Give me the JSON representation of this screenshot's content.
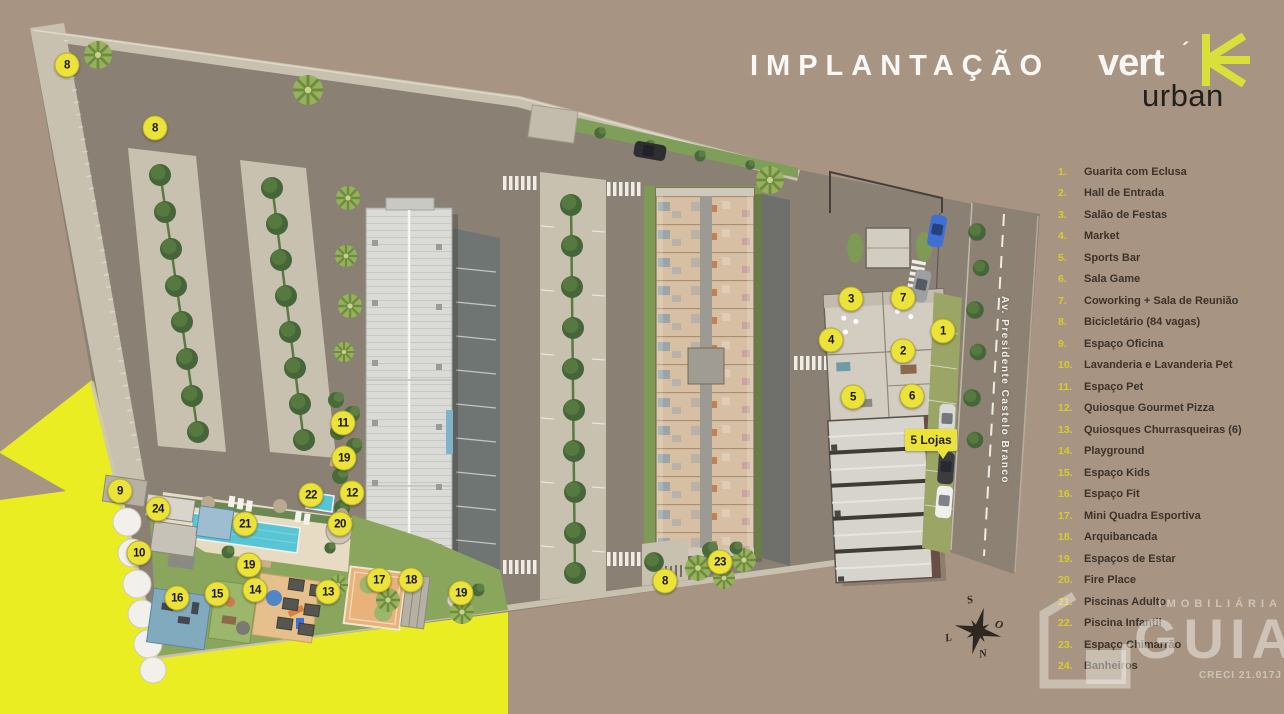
{
  "header": {
    "title": "IMPLANTAÇÃO"
  },
  "logo": {
    "brand": "vert",
    "accent": "´",
    "sub": "urban"
  },
  "legend": {
    "items": [
      {
        "n": "1.",
        "label": "Guarita com Eclusa"
      },
      {
        "n": "2.",
        "label": "Hall de Entrada"
      },
      {
        "n": "3.",
        "label": "Salão de Festas"
      },
      {
        "n": "4.",
        "label": "Market"
      },
      {
        "n": "5.",
        "label": "Sports Bar"
      },
      {
        "n": "6.",
        "label": "Sala Game"
      },
      {
        "n": "7.",
        "label": "Coworking + Sala de Reunião"
      },
      {
        "n": "8.",
        "label": "Bicicletário (84 vagas)"
      },
      {
        "n": "9.",
        "label": "Espaço Oficina"
      },
      {
        "n": "10.",
        "label": "Lavanderia e Lavanderia Pet"
      },
      {
        "n": "11.",
        "label": "Espaço Pet"
      },
      {
        "n": "12.",
        "label": "Quiosque Gourmet Pizza"
      },
      {
        "n": "13.",
        "label": "Quiosques Churrasqueiras (6)"
      },
      {
        "n": "14.",
        "label": "Playground"
      },
      {
        "n": "15.",
        "label": "Espaço Kids"
      },
      {
        "n": "16.",
        "label": "Espaço Fit"
      },
      {
        "n": "17.",
        "label": "Mini Quadra Esportiva"
      },
      {
        "n": "18.",
        "label": "Arquibancada"
      },
      {
        "n": "19.",
        "label": "Espaços de Estar"
      },
      {
        "n": "20.",
        "label": "Fire Place"
      },
      {
        "n": "21.",
        "label": "Piscinas Adulto"
      },
      {
        "n": "22.",
        "label": "Piscina Infantil"
      },
      {
        "n": "23.",
        "label": "Espaço Chimarrão"
      },
      {
        "n": "24.",
        "label": "Banheiros"
      }
    ]
  },
  "map": {
    "street_name": "Av. Presidente Castelo Branco",
    "lojas_label": "5 Lojas",
    "markers": [
      {
        "label": "8",
        "x": 67,
        "y": 65
      },
      {
        "label": "8",
        "x": 155,
        "y": 128
      },
      {
        "label": "11",
        "x": 343,
        "y": 423
      },
      {
        "label": "19",
        "x": 344,
        "y": 458
      },
      {
        "label": "22",
        "x": 311,
        "y": 495
      },
      {
        "label": "12",
        "x": 352,
        "y": 493
      },
      {
        "label": "21",
        "x": 245,
        "y": 524
      },
      {
        "label": "20",
        "x": 340,
        "y": 524
      },
      {
        "label": "9",
        "x": 120,
        "y": 491
      },
      {
        "label": "24",
        "x": 158,
        "y": 509
      },
      {
        "label": "10",
        "x": 139,
        "y": 553
      },
      {
        "label": "19",
        "x": 249,
        "y": 565
      },
      {
        "label": "16",
        "x": 177,
        "y": 598
      },
      {
        "label": "15",
        "x": 217,
        "y": 594
      },
      {
        "label": "14",
        "x": 255,
        "y": 590
      },
      {
        "label": "13",
        "x": 328,
        "y": 592
      },
      {
        "label": "17",
        "x": 379,
        "y": 580
      },
      {
        "label": "18",
        "x": 411,
        "y": 580
      },
      {
        "label": "19",
        "x": 461,
        "y": 593
      },
      {
        "label": "8",
        "x": 665,
        "y": 581
      },
      {
        "label": "23",
        "x": 720,
        "y": 562
      },
      {
        "label": "3",
        "x": 851,
        "y": 299
      },
      {
        "label": "7",
        "x": 903,
        "y": 298
      },
      {
        "label": "4",
        "x": 831,
        "y": 340
      },
      {
        "label": "2",
        "x": 903,
        "y": 351
      },
      {
        "label": "5",
        "x": 853,
        "y": 397
      },
      {
        "label": "6",
        "x": 912,
        "y": 396
      },
      {
        "label": "1",
        "x": 943,
        "y": 331
      }
    ]
  },
  "compass": {
    "top": "S",
    "right": "O",
    "bottom": "N",
    "left": "L"
  },
  "watermark": {
    "tagline": "IMOBILIÁRIA",
    "brand": "GUIA",
    "creci": "CRECI 21.017J"
  },
  "palette": {
    "background": "#a89482",
    "site_gray": "#8a8174",
    "gravel": "#c8c1af",
    "dark_gravel": "#6f7572",
    "marker_yellow": "#ece33a",
    "brand_yellow": "#d9e03c",
    "wedge_yellow": "#e9ed21",
    "pool_blue": "#58c5d5",
    "tree_green": "#46663a",
    "lawn_green": "#8aa65c",
    "roof_white": "#dadad6",
    "floorplan_beige": "#d6bfa3",
    "legend_text": "#3a332b",
    "legend_number": "#d8cc2e",
    "title_white": "#faf8f4"
  }
}
